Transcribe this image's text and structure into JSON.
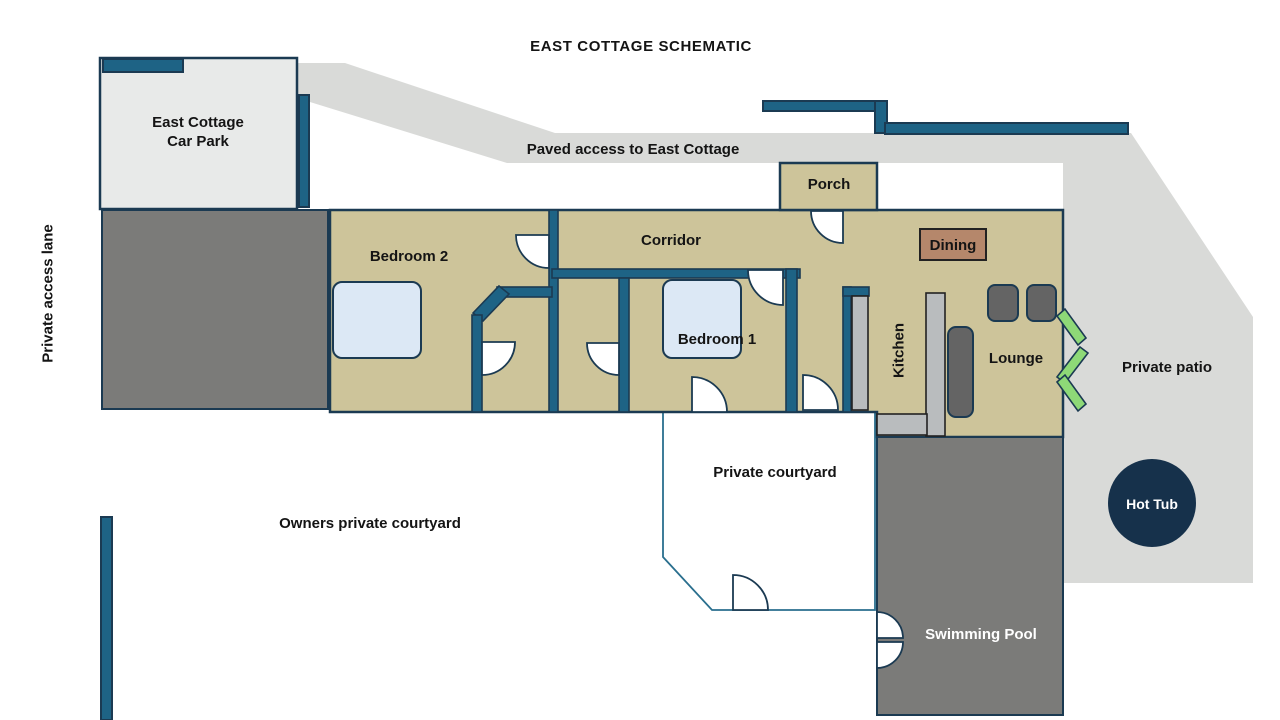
{
  "title": "EAST COTTAGE SCHEMATIC",
  "areas": {
    "car_park": {
      "label": "East Cottage Car Park"
    },
    "access_lane": {
      "label": "Private access lane"
    },
    "paved_access": {
      "label": "Paved access to East Cottage"
    },
    "porch": {
      "label": "Porch"
    },
    "corridor": {
      "label": "Corridor"
    },
    "bedroom2": {
      "label": "Bedroom 2"
    },
    "bedroom1": {
      "label": "Bedroom 1"
    },
    "dining": {
      "label": "Dining"
    },
    "kitchen": {
      "label": "Kitchen"
    },
    "lounge": {
      "label": "Lounge"
    },
    "private_patio": {
      "label": "Private patio"
    },
    "hot_tub": {
      "label": "Hot Tub"
    },
    "private_courtyard": {
      "label": "Private courtyard"
    },
    "owners_courtyard": {
      "label": "Owners private courtyard"
    },
    "swimming_pool": {
      "label": "Swimming Pool"
    }
  },
  "colors": {
    "wall_teal": "#1e6385",
    "outline_navy": "#1b3a52",
    "cottage_tan": "#cdc49a",
    "paving_gray": "#d9dad8",
    "carpark_gray": "#e8eae9",
    "dark_gray": "#7b7b79",
    "bed_blue": "#dce8f5",
    "furniture_gray": "#646464",
    "counter_gray": "#b9bcbe",
    "door_green": "#8ed977",
    "hot_tub_navy": "#16314b",
    "dining_brown": "#b5876b",
    "courtyard_line": "#2a6f8e"
  }
}
